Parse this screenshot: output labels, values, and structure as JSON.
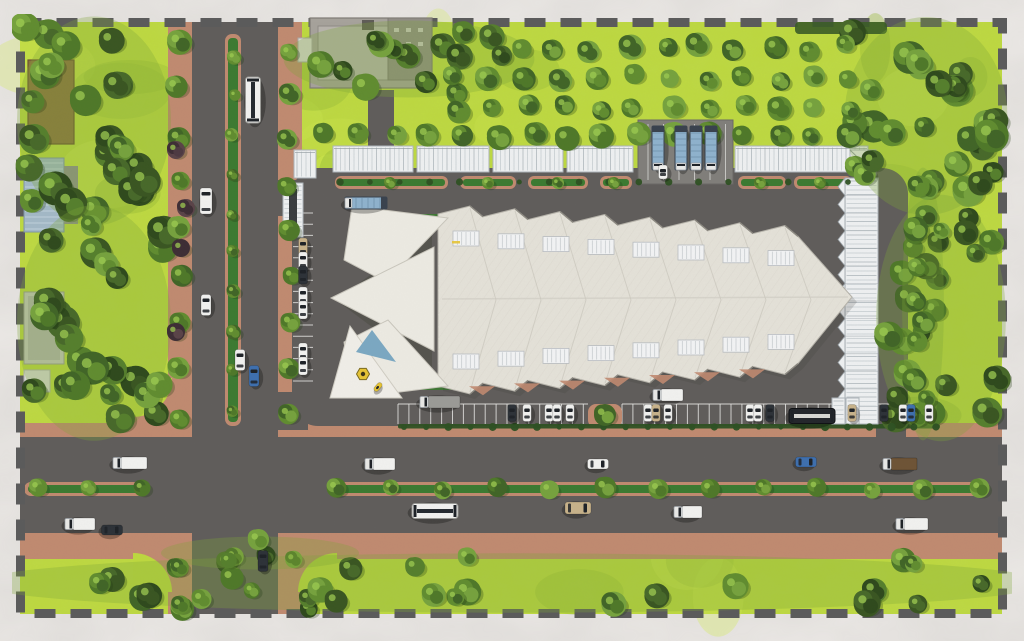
{
  "meta": {
    "title": "Aerial site plan rendering",
    "description": "Top-down 3D architectural rendering of a terminal and market complex with a white sawtooth roof, canopies, truck and car parking, tree-lined roads with planted medians, and a dashed site boundary on a white marble background.",
    "visible_text": []
  },
  "canvas": {
    "w": 1024,
    "h": 641
  },
  "palette": {
    "bg": "#ece9e6",
    "bgVein": "#6f6d6a",
    "grass": "#bdd83f",
    "grassLight": "#d3ec55",
    "grassDark": "#96ba37",
    "road": "#605d5b",
    "roadLight": "#6b6764",
    "sidewalk": "#c08a70",
    "sidewalkDark": "#b27a60",
    "median": "#3c7a31",
    "hedge": "#2e5123",
    "canopy": "#eef0f1",
    "canopyRib": "#cfd5d8",
    "canopyRib2": "#bcc3c7",
    "canopyEdge": "#9aa2a7",
    "roof": "#e4e1d8",
    "roofSeam": "#cdcac0",
    "roofTex": "#d8d5cb",
    "roofShadow": "#8d8a82",
    "starWhite": "#eceae2",
    "starDark": "#55544e",
    "boundary": "#5b5b5b",
    "building": "#a6a29b",
    "buildingWing": "#918d86",
    "buildingCourt": "#b7b3ac",
    "buildingDark": "#5f5c57",
    "brownRoof": "#8b713e",
    "glassRoof": "#a3b8c6",
    "grayRoof": "#c6c6c1",
    "truckBlue": "#8fb2cd",
    "yellow": "#e6c435",
    "blueGlass": "#7ba8c2",
    "carWhite": "#f1f1ef",
    "carDark": "#2d3238",
    "carTan": "#c7b28a",
    "carBlue": "#3e6fae",
    "carBrown": "#6e5436",
    "carGray": "#9b9b97",
    "window": "#1e2227"
  },
  "boundary": {
    "x": 20.5,
    "y": 22.5,
    "w": 982,
    "h": 591,
    "dash": [
      21,
      15
    ],
    "width": 9
  },
  "roads": {
    "vertical": {
      "x": 192,
      "y": 22,
      "w": 86,
      "h": 592
    },
    "horizontal": {
      "x": 20,
      "y": 437,
      "w": 982,
      "h": 96
    },
    "connectors": [
      {
        "x": 274,
        "y": 180,
        "w": 34,
        "h": 36
      },
      {
        "x": 274,
        "y": 392,
        "w": 34,
        "h": 38
      },
      {
        "x": 876,
        "y": 420,
        "w": 30,
        "h": 17
      },
      {
        "x": 368,
        "y": 90,
        "w": 26,
        "h": 56
      }
    ]
  },
  "sidewalks": {
    "rects": [
      {
        "x": 168,
        "y": 22,
        "w": 24,
        "h": 415
      },
      {
        "x": 278,
        "y": 22,
        "w": 24,
        "h": 410
      },
      {
        "x": 168,
        "y": 533,
        "w": 24,
        "h": 81
      },
      {
        "x": 278,
        "y": 533,
        "w": 24,
        "h": 81
      },
      {
        "x": 20,
        "y": 423,
        "w": 982,
        "h": 14
      },
      {
        "x": 20,
        "y": 533,
        "w": 982,
        "h": 26
      }
    ],
    "filletR": 59,
    "filletInnerR": 39,
    "corners": [
      [
        192,
        437,
        -1,
        -1
      ],
      [
        278,
        437,
        1,
        -1
      ],
      [
        192,
        533,
        -1,
        1
      ],
      [
        278,
        533,
        1,
        1
      ]
    ]
  },
  "medians": {
    "vertical": {
      "curb": [
        225,
        34,
        16,
        392
      ],
      "green": [
        228,
        38,
        10,
        384
      ]
    },
    "hRight": {
      "curb": [
        332,
        482,
        652,
        14
      ],
      "green": [
        336,
        485,
        644,
        8
      ]
    },
    "hLeft": {
      "curb": [
        24,
        482,
        122,
        14
      ],
      "green": [
        28,
        485,
        114,
        8
      ]
    }
  },
  "complex": {
    "pavement": {
      "x": 292,
      "y": 168,
      "w": 616,
      "h": 258,
      "r": 26
    },
    "truckBay": {
      "x": 638,
      "y": 120,
      "w": 95,
      "h": 64
    },
    "islands": {
      "y": 176,
      "h": 13,
      "list": [
        [
          335,
          113
        ],
        [
          460,
          56
        ],
        [
          528,
          60
        ],
        [
          600,
          32
        ],
        [
          738,
          48
        ],
        [
          794,
          58
        ]
      ]
    },
    "greenWedges": [
      [
        412,
        214,
        470,
        214,
        430,
        228
      ],
      [
        412,
        390,
        470,
        390,
        430,
        376
      ]
    ],
    "canopiesNorth": [
      [
        333,
        146,
        80,
        26
      ],
      [
        417,
        146,
        72,
        26
      ],
      [
        493,
        146,
        70,
        26
      ],
      [
        567,
        146,
        66,
        26
      ],
      [
        735,
        146,
        133,
        26
      ]
    ],
    "canopyEast": {
      "x": 845,
      "y": 178,
      "w": 33,
      "h": 246
    },
    "cornerTent": {
      "x": 850,
      "y": 150,
      "w": 26,
      "h": 25
    },
    "seTents": [
      [
        832,
        398,
        13,
        26
      ],
      [
        846,
        398,
        13,
        26
      ]
    ],
    "gates": [
      {
        "x": 294,
        "y": 150,
        "w": 22,
        "h": 28,
        "ribs": "v"
      },
      {
        "x": 283,
        "y": 183,
        "w": 20,
        "h": 54,
        "ribs": "h",
        "inner": true
      }
    ]
  },
  "mainRoof": {
    "x0": 438,
    "teeth": 8,
    "toothW": 45,
    "topY": 214,
    "botY": 386,
    "slope": 2.8,
    "tipRise": 8,
    "tipAt": 32,
    "eastTip": [
      852,
      297
    ],
    "skylight": {
      "w": 26,
      "h": 15,
      "offset": 17
    }
  },
  "star": {
    "backWedge": [
      [
        432,
        230
      ],
      [
        432,
        372
      ],
      [
        336,
        300
      ]
    ],
    "wings": [
      [
        [
          352,
          206
        ],
        [
          448,
          218
        ],
        [
          386,
          282
        ],
        [
          344,
          260
        ]
      ],
      [
        [
          331,
          298
        ],
        [
          434,
          247
        ],
        [
          434,
          351
        ]
      ],
      [
        [
          352,
          398
        ],
        [
          448,
          386
        ],
        [
          388,
          320
        ],
        [
          344,
          342
        ]
      ]
    ],
    "plaza": [
      [
        350,
        326
      ],
      [
        402,
        398
      ],
      [
        330,
        398
      ]
    ],
    "blueTri": [
      [
        372,
        330
      ],
      [
        396,
        362
      ],
      [
        356,
        352
      ]
    ],
    "logo": {
      "x": 363,
      "y": 374,
      "r": 6.5
    },
    "yellowMark": [
      452,
      241
    ]
  },
  "structures": {
    "topBuilding": {
      "base": [
        310,
        18,
        122,
        70
      ],
      "court": [
        318,
        26,
        70,
        54
      ],
      "wing": [
        388,
        18,
        44,
        62
      ],
      "core": [
        362,
        20,
        12,
        10
      ],
      "annex": [
        298,
        38,
        14,
        24
      ]
    },
    "brownCanopy": [
      28,
      60,
      46,
      84
    ],
    "glassBuilding": {
      "roof": [
        24,
        158,
        40,
        74
      ],
      "annex": [
        64,
        166,
        14,
        58
      ]
    },
    "grayBuilding": {
      "roof": [
        24,
        292,
        40,
        72
      ],
      "inner": [
        28,
        296,
        32,
        64
      ],
      "small": [
        24,
        370,
        26,
        22
      ]
    },
    "hedgeStrip": [
      795,
      22,
      92,
      12
    ],
    "orangeBit": [
      843,
      22,
      10,
      7
    ]
  },
  "vegetation": {
    "seed": 7,
    "rows": [
      {
        "x1": 179,
        "y1": 42,
        "x2": 179,
        "y2": 418,
        "n": 9,
        "r": 11,
        "jit": 3
      },
      {
        "x1": 289,
        "y1": 50,
        "x2": 289,
        "y2": 412,
        "n": 9,
        "r": 10,
        "jit": 3
      },
      {
        "x1": 233,
        "y1": 56,
        "x2": 233,
        "y2": 410,
        "n": 10,
        "r": 6.5,
        "jit": 2
      },
      {
        "x1": 179,
        "y1": 566,
        "x2": 179,
        "y2": 606,
        "n": 2,
        "r": 11,
        "jit": 2
      },
      {
        "x1": 338,
        "y1": 489,
        "x2": 978,
        "y2": 489,
        "n": 13,
        "r": 9.5,
        "jit": 2
      },
      {
        "x1": 38,
        "y1": 489,
        "x2": 142,
        "y2": 489,
        "n": 3,
        "r": 9,
        "jit": 2
      },
      {
        "x1": 520,
        "y1": 48,
        "x2": 845,
        "y2": 48,
        "n": 10,
        "r": 11,
        "jit": 4
      },
      {
        "x1": 455,
        "y1": 78,
        "x2": 850,
        "y2": 78,
        "n": 12,
        "r": 11,
        "jit": 4
      },
      {
        "x1": 455,
        "y1": 108,
        "x2": 850,
        "y2": 108,
        "n": 12,
        "r": 11,
        "jit": 4
      },
      {
        "x1": 325,
        "y1": 136,
        "x2": 848,
        "y2": 136,
        "n": 16,
        "r": 11,
        "jit": 3
      },
      {
        "x1": 916,
        "y1": 188,
        "x2": 916,
        "y2": 420,
        "n": 7,
        "r": 11,
        "jit": 3
      }
    ],
    "clusters": [
      {
        "x": 24,
        "y": 26,
        "w": 140,
        "h": 190,
        "n": 26,
        "rmin": 10,
        "rmax": 17
      },
      {
        "x": 24,
        "y": 216,
        "w": 140,
        "h": 214,
        "n": 24,
        "rmin": 10,
        "rmax": 17
      },
      {
        "x": 852,
        "y": 26,
        "w": 148,
        "h": 180,
        "n": 26,
        "rmin": 10,
        "rmax": 17
      },
      {
        "x": 882,
        "y": 206,
        "w": 118,
        "h": 224,
        "n": 20,
        "rmin": 9,
        "rmax": 15
      },
      {
        "x": 24,
        "y": 556,
        "w": 976,
        "h": 54,
        "n": 30,
        "rmin": 8,
        "rmax": 14
      },
      {
        "x": 295,
        "y": 24,
        "w": 228,
        "h": 70,
        "n": 14,
        "rmin": 9,
        "rmax": 14
      },
      {
        "x": 904,
        "y": 180,
        "w": 38,
        "h": 248,
        "n": 9,
        "rmin": 8,
        "rmax": 12
      },
      {
        "x": 170,
        "y": 538,
        "w": 180,
        "h": 30,
        "n": 4,
        "rmin": 8,
        "rmax": 12
      }
    ],
    "maroonTrees": [
      [
        176,
        150
      ],
      [
        181,
        248
      ],
      [
        176,
        332
      ],
      [
        186,
        208
      ]
    ],
    "bushRows": [
      {
        "x1": 404,
        "y1": 427,
        "x2": 936,
        "y2": 427,
        "n": 25,
        "r": 3.2
      },
      {
        "x1": 340,
        "y1": 182,
        "x2": 848,
        "y2": 182,
        "n": 18,
        "r": 3
      }
    ],
    "islandTrees": [
      [
        390,
        183
      ],
      [
        488,
        183
      ],
      [
        558,
        183
      ],
      [
        614,
        183
      ],
      [
        760,
        183
      ],
      [
        820,
        183
      ]
    ],
    "patches": {
      "light": 36,
      "dark": 26
    }
  },
  "parking": {
    "south": {
      "x1": 398,
      "x2": 588,
      "x3": 622,
      "x4": 940,
      "y": 404,
      "h": 20,
      "step": 10.9,
      "hedge": [
        398,
        424,
        542,
        4.5
      ],
      "island": [
        588,
        404,
        34,
        24
      ],
      "cars": [
        [
          512,
          "carDark"
        ],
        [
          527,
          "carWhite"
        ],
        [
          549,
          "carWhite"
        ],
        [
          557,
          "carWhite"
        ],
        [
          570,
          "carWhite"
        ],
        [
          648,
          "carWhite"
        ],
        [
          656,
          "carTan"
        ],
        [
          668,
          "carWhite"
        ],
        [
          750,
          "carWhite"
        ],
        [
          758,
          "carWhite"
        ],
        [
          770,
          "carDark"
        ],
        [
          852,
          "carTan"
        ],
        [
          884,
          "carDark"
        ],
        [
          903,
          "carWhite"
        ],
        [
          911,
          "carBlue"
        ],
        [
          929,
          "carWhite"
        ]
      ]
    },
    "west": {
      "x": 293,
      "w": 20,
      "y1": 213,
      "y2": 392,
      "step": 11.2,
      "cars": [
        [
          247,
          "carTan"
        ],
        [
          261,
          "carWhite"
        ],
        [
          275,
          "carDark"
        ],
        [
          296,
          "carWhite"
        ],
        [
          310,
          "carWhite"
        ],
        [
          352,
          "carWhite"
        ],
        [
          366,
          "carWhite"
        ]
      ]
    }
  },
  "vehicles": [
    {
      "t": "bus",
      "x": 253,
      "y": 100,
      "a": 0,
      "c": "carWhite"
    },
    {
      "t": "van",
      "x": 206,
      "y": 201,
      "a": 0,
      "c": "carWhite"
    },
    {
      "t": "car",
      "x": 206,
      "y": 305,
      "a": 0,
      "c": "carWhite"
    },
    {
      "t": "car",
      "x": 240,
      "y": 360,
      "a": 0,
      "c": "carWhite"
    },
    {
      "t": "car",
      "x": 254,
      "y": 376,
      "a": 0,
      "c": "carBlue"
    },
    {
      "t": "car",
      "x": 263,
      "y": 561,
      "a": 0,
      "c": "carDark"
    },
    {
      "t": "box",
      "x": 130,
      "y": 463,
      "a": 90,
      "c": "carWhite",
      "l": 34
    },
    {
      "t": "box",
      "x": 380,
      "y": 464,
      "a": 90,
      "c": "carWhite",
      "l": 30
    },
    {
      "t": "car",
      "x": 598,
      "y": 464,
      "a": 90,
      "c": "carWhite"
    },
    {
      "t": "car",
      "x": 806,
      "y": 462,
      "a": 90,
      "c": "carBlue"
    },
    {
      "t": "box",
      "x": 900,
      "y": 464,
      "a": 90,
      "c": "carBrown",
      "l": 34
    },
    {
      "t": "bus",
      "x": 435,
      "y": 511,
      "a": 90,
      "c": "carWhite"
    },
    {
      "t": "van",
      "x": 578,
      "y": 508,
      "a": 90,
      "c": "carTan"
    },
    {
      "t": "box",
      "x": 688,
      "y": 512,
      "a": 90,
      "c": "carWhite",
      "l": 28
    },
    {
      "t": "box",
      "x": 912,
      "y": 524,
      "a": 90,
      "c": "carWhite",
      "l": 32
    },
    {
      "t": "box",
      "x": 80,
      "y": 524,
      "a": 90,
      "c": "carWhite",
      "l": 30
    },
    {
      "t": "car",
      "x": 112,
      "y": 530,
      "a": 90,
      "c": "carDark"
    },
    {
      "t": "semi",
      "x": 366,
      "y": 203,
      "a": 90,
      "c": "truckBlue",
      "l": 42
    },
    {
      "t": "box",
      "x": 440,
      "y": 402,
      "a": 90,
      "c": "carGray",
      "l": 40
    },
    {
      "t": "box",
      "x": 668,
      "y": 395,
      "a": 90,
      "c": "carWhite",
      "l": 30
    },
    {
      "t": "semi",
      "x": 658,
      "y": 148,
      "a": 0,
      "c": "truckBlue"
    },
    {
      "t": "semi",
      "x": 681,
      "y": 148,
      "a": 0,
      "c": "truckBlue"
    },
    {
      "t": "semi",
      "x": 696,
      "y": 148,
      "a": 0,
      "c": "truckBlue"
    },
    {
      "t": "semi",
      "x": 711,
      "y": 148,
      "a": 0,
      "c": "truckBlue"
    },
    {
      "t": "van",
      "x": 663,
      "y": 172,
      "a": 0,
      "c": "carWhite",
      "l": 14,
      "w": 9
    },
    {
      "t": "bus",
      "x": 812,
      "y": 416,
      "a": 90,
      "c": "carDark",
      "l": 46
    },
    {
      "t": "car",
      "x": 378,
      "y": 387,
      "a": 40,
      "c": "yellow",
      "l": 10,
      "w": 5
    }
  ]
}
